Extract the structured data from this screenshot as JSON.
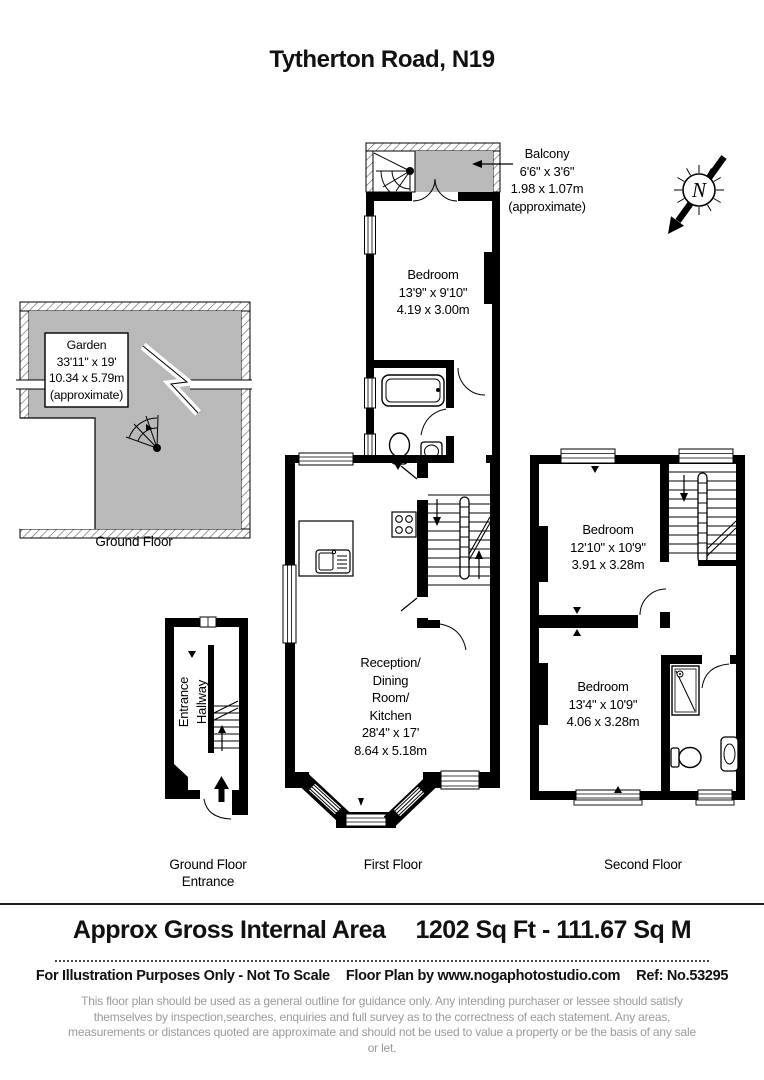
{
  "title": "Tytherton Road, N19",
  "compass": {
    "label": "N"
  },
  "rooms": {
    "balcony": {
      "name": "Balcony",
      "imperial": "6'6\" x 3'6\"",
      "metric": "1.98 x 1.07m",
      "note": "(approximate)"
    },
    "bedroom_first_floor": {
      "name": "Bedroom",
      "imperial": "13'9\" x 9'10\"",
      "metric": "4.19 x 3.00m"
    },
    "garden": {
      "name": "Garden",
      "imperial": "33'11\" x 19'",
      "metric": "10.34 x 5.79m",
      "note": "(approximate)"
    },
    "reception": {
      "name_line1": "Reception/",
      "name_line2": "Dining",
      "name_line3": "Room/",
      "name_line4": "Kitchen",
      "imperial": "28'4\" x 17'",
      "metric": "8.64 x 5.18m"
    },
    "bedroom_second_floor_front": {
      "name": "Bedroom",
      "imperial": "12'10\" x 10'9\"",
      "metric": "3.91 x 3.28m"
    },
    "bedroom_second_floor_back": {
      "name": "Bedroom",
      "imperial": "13'4\" x 10'9\"",
      "metric": "4.06 x 3.28m"
    },
    "entrance_hallway": {
      "line1": "Entrance",
      "line2": "Hallway"
    }
  },
  "captions": {
    "ground_floor": "Ground Floor",
    "ground_floor_entrance_line1": "Ground Floor",
    "ground_floor_entrance_line2": "Entrance",
    "first_floor": "First Floor",
    "second_floor": "Second Floor"
  },
  "footer": {
    "area_label": "Approx Gross Internal Area",
    "area_value": "1202 Sq Ft  -  111.67 Sq M",
    "illustration_note": "For Illustration Purposes Only - Not To Scale",
    "credit": "Floor Plan by www.nogaphotostudio.com",
    "reference": "Ref: No.53295",
    "disclaimer": "This floor plan should be used as a general outline for guidance only. Any intending purchaser or lessee should satisfy themselves by inspection,searches, enquiries and full survey as to the correctness of each statement. Any areas, measurements or distances quoted are approximate and should not be used to value a property or be the basis of any sale or let."
  },
  "colors": {
    "area_fill": "#b9b9b9",
    "walls": "#000000",
    "disclaimer_text": "#9b9b9b"
  }
}
